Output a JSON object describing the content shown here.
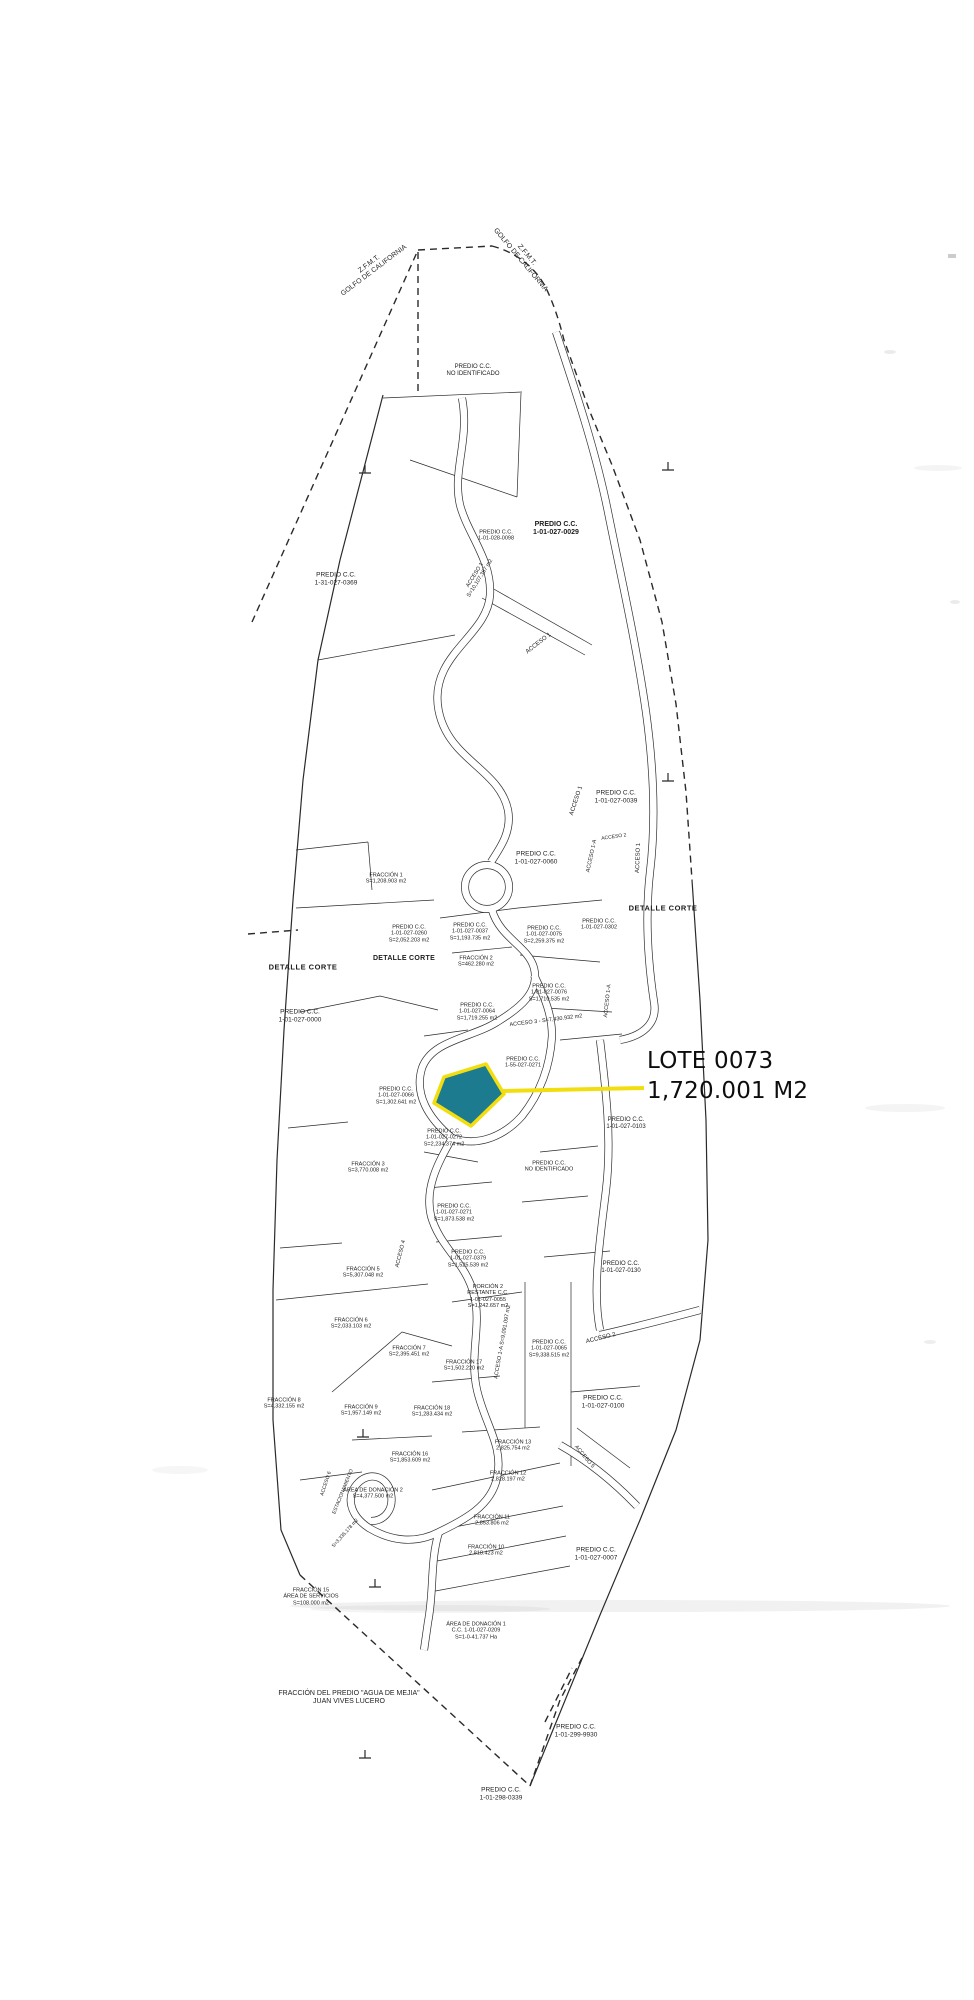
{
  "page": {
    "background": "#ffffff"
  },
  "ink": "#2a2a2a",
  "callout": {
    "title": "LOTE 0073",
    "area": "1,720.001 M2"
  },
  "highlight": {
    "fill": "#1c7b8e",
    "stroke": "#f2de0e",
    "leader_color": "#f2de0e"
  },
  "map": {
    "labels": [
      {
        "text": "Z.F.M.T.\nGOLFO DE CALIFORNIA",
        "x": 372,
        "y": 268,
        "rot": -37,
        "size": 7
      },
      {
        "text": "Z.F.M.T.\nGOLFO DE CALIFORNIA",
        "x": 523,
        "y": 258,
        "rot": 50,
        "size": 7
      },
      {
        "text": "PREDIO C.C.\nNO IDENTIFICADO",
        "x": 473,
        "y": 371,
        "rot": 0,
        "size": 6
      },
      {
        "text": "PREDIO C.C.\n1-31-027-0369",
        "x": 336,
        "y": 579,
        "rot": 0,
        "size": 6.5
      },
      {
        "text": "PREDIO C.C.\n1-01-028-0098",
        "x": 496,
        "y": 536,
        "rot": 0,
        "size": 5.5
      },
      {
        "text": "PREDIO C.C.\n1-01-027-0029",
        "x": 556,
        "y": 529,
        "rot": 0,
        "size": 7,
        "weight": 700
      },
      {
        "text": "ACCESO 1\nS=10,107.387 m2",
        "x": 478,
        "y": 577,
        "rot": -58,
        "size": 5.5
      },
      {
        "text": "ACCESO 1",
        "x": 539,
        "y": 644,
        "rot": -38,
        "size": 6
      },
      {
        "text": "PREDIO C.C.\n1-01-027-0039",
        "x": 616,
        "y": 797,
        "rot": 0,
        "size": 6.5
      },
      {
        "text": "ACCESO 1",
        "x": 577,
        "y": 801,
        "rot": -72,
        "size": 6
      },
      {
        "text": "ACCESO 2",
        "x": 614,
        "y": 838,
        "rot": -8,
        "size": 5
      },
      {
        "text": "ACCESO 1-A",
        "x": 592,
        "y": 856,
        "rot": -78,
        "size": 5.5
      },
      {
        "text": "ACCESO 1",
        "x": 639,
        "y": 858,
        "rot": -88,
        "size": 6
      },
      {
        "text": "PREDIO C.C.\n1-01-027-0060",
        "x": 536,
        "y": 858,
        "rot": 0,
        "size": 6.5
      },
      {
        "text": "FRACCIÓN 1\nS=1,208.903 m2",
        "x": 386,
        "y": 879,
        "rot": 0,
        "size": 5.5
      },
      {
        "text": "DETALLE CORTE",
        "x": 303,
        "y": 968,
        "rot": 0,
        "size": 7.5,
        "weight": 600,
        "spacing": 0.5
      },
      {
        "text": "DETALLE CORTE",
        "x": 663,
        "y": 909,
        "rot": 0,
        "size": 7.5,
        "weight": 600,
        "spacing": 0.5
      },
      {
        "text": "PREDIO C.C.\n1-01-027-0260\nS=2,052.203 m2",
        "x": 409,
        "y": 934,
        "rot": 0,
        "size": 5.5
      },
      {
        "text": "DETALLE CORTE",
        "x": 404,
        "y": 959,
        "rot": 0,
        "size": 7,
        "weight": 700,
        "spacing": 0.3
      },
      {
        "text": "PREDIO C.C.\n1-01-027-0037\nS=1,193.735 m2",
        "x": 470,
        "y": 932,
        "rot": 0,
        "size": 5.5
      },
      {
        "text": "PREDIO C.C.\n1-01-027-0075\nS=2,259.375 m2",
        "x": 544,
        "y": 935,
        "rot": 0,
        "size": 5.5
      },
      {
        "text": "PREDIO C.C.\n1-01-027-0302",
        "x": 599,
        "y": 925,
        "rot": 0,
        "size": 5.5
      },
      {
        "text": "FRACCIÓN 2\nS=462.280 m2",
        "x": 476,
        "y": 962,
        "rot": 0,
        "size": 5.5
      },
      {
        "text": "PREDIO C.C.\n1-01-027-0076\nS=1,710.535 m2",
        "x": 549,
        "y": 993,
        "rot": 0,
        "size": 5.5
      },
      {
        "text": "PREDIO C.C.\n1-01-027-0064\nS=1,719.255 m2",
        "x": 477,
        "y": 1012,
        "rot": 0,
        "size": 5.5
      },
      {
        "text": "ACCESO 3 - S=7,430.932 m2",
        "x": 546,
        "y": 1021,
        "rot": -7,
        "size": 5.5
      },
      {
        "text": "ACCESO 1-A",
        "x": 608,
        "y": 1001,
        "rot": -84,
        "size": 5.5
      },
      {
        "text": "PREDIO C.C.\n1-01-027-0000",
        "x": 300,
        "y": 1016,
        "rot": 0,
        "size": 6.5
      },
      {
        "text": "PREDIO C.C.\n1-01-027-0066\nS=1,302.641 m2",
        "x": 396,
        "y": 1096,
        "rot": 0,
        "size": 5.5
      },
      {
        "text": "PREDIO C.C.\n1-55-027-0271",
        "x": 523,
        "y": 1063,
        "rot": 0,
        "size": 5.5
      },
      {
        "text": "PREDIO C.C.\n1-01-027-0272\nS=2,234.374 m2",
        "x": 444,
        "y": 1138,
        "rot": 0,
        "size": 5.5
      },
      {
        "text": "PREDIO C.C.\n1-01-027-0103",
        "x": 626,
        "y": 1124,
        "rot": 0,
        "size": 6
      },
      {
        "text": "PREDIO C.C.\nNO IDENTIFICADO",
        "x": 549,
        "y": 1167,
        "rot": 0,
        "size": 5.5
      },
      {
        "text": "FRACCIÓN 3\nS=3,770.008 m2",
        "x": 368,
        "y": 1168,
        "rot": 0,
        "size": 5.5
      },
      {
        "text": "PREDIO C.C.\n1-01-027-0271\nS=1,873.538 m2",
        "x": 454,
        "y": 1213,
        "rot": 0,
        "size": 5.5
      },
      {
        "text": "PREDIO C.C.\n1-01-027-0379\nS=1,525.539 m2",
        "x": 468,
        "y": 1259,
        "rot": 0,
        "size": 5.5
      },
      {
        "text": "FRACCIÓN 5\nS=5,307.048 m2",
        "x": 363,
        "y": 1273,
        "rot": 0,
        "size": 5.5
      },
      {
        "text": "ACCESO 4",
        "x": 401,
        "y": 1254,
        "rot": -76,
        "size": 5.5
      },
      {
        "text": "PREDIO C.C.\n1-01-027-0130",
        "x": 621,
        "y": 1268,
        "rot": 0,
        "size": 6
      },
      {
        "text": "FRACCIÓN 6\nS=2,033.103 m2",
        "x": 351,
        "y": 1324,
        "rot": 0,
        "size": 5.5
      },
      {
        "text": "PORCIÓN 2\nRESTANTE C.C.\n1-01-027-0055\nS=1,242.657 m2",
        "x": 488,
        "y": 1297,
        "rot": 0,
        "size": 5.5
      },
      {
        "text": "FRACCIÓN 7\nS=2,395.451 m2",
        "x": 409,
        "y": 1352,
        "rot": 0,
        "size": 5.5
      },
      {
        "text": "FRACCIÓN 17\nS=1,502.220 m2",
        "x": 464,
        "y": 1366,
        "rot": 0,
        "size": 5.5
      },
      {
        "text": "ACCESO 1-A  S=9,091.097 m2",
        "x": 503,
        "y": 1342,
        "rot": -80,
        "size": 5.5
      },
      {
        "text": "PREDIO C.C.\n1-01-027-0065\nS=9,338.515 m2",
        "x": 549,
        "y": 1349,
        "rot": 0,
        "size": 5.5
      },
      {
        "text": "ACCESO 2",
        "x": 601,
        "y": 1339,
        "rot": -14,
        "size": 6
      },
      {
        "text": "PREDIO C.C.\n1-01-027-0100",
        "x": 603,
        "y": 1402,
        "rot": 0,
        "size": 6.5
      },
      {
        "text": "FRACCIÓN 9\nS=1,957.149 m2",
        "x": 361,
        "y": 1411,
        "rot": 0,
        "size": 5.5
      },
      {
        "text": "FRACCIÓN 18\nS=1,283.434 m2",
        "x": 432,
        "y": 1412,
        "rot": 0,
        "size": 5.5
      },
      {
        "text": "FRACCIÓN 13\n2,825.754 m2",
        "x": 513,
        "y": 1446,
        "rot": 0,
        "size": 5.5
      },
      {
        "text": "FRACCIÓN 16\nS=1,853.609 m2",
        "x": 410,
        "y": 1458,
        "rot": 0,
        "size": 5.5
      },
      {
        "text": "ACCESO 5",
        "x": 584,
        "y": 1457,
        "rot": 50,
        "size": 5.5
      },
      {
        "text": "FRACCIÓN 8\nS=4,332.155 m2",
        "x": 284,
        "y": 1404,
        "rot": 0,
        "size": 5.5
      },
      {
        "text": "ÁREA DE DONACIÓN 2\nS=4,377.500 m2",
        "x": 373,
        "y": 1494,
        "rot": 0,
        "size": 5.5
      },
      {
        "text": "FRACCIÓN 12\n2,828.197 m2",
        "x": 508,
        "y": 1477,
        "rot": 0,
        "size": 5.5
      },
      {
        "text": "FRACCIÓN 11\n2,853.806 m2",
        "x": 492,
        "y": 1521,
        "rot": 0,
        "size": 5.5
      },
      {
        "text": "FRACCIÓN 10\n2,818.423 m2",
        "x": 486,
        "y": 1551,
        "rot": 0,
        "size": 5.5
      },
      {
        "text": "PREDIO C.C.\n1-01-027-0007",
        "x": 596,
        "y": 1554,
        "rot": 0,
        "size": 6.5
      },
      {
        "text": "FRACCIÓN 15\nÁREA DE SERVICIOS\nS=108.000 m2",
        "x": 311,
        "y": 1597,
        "rot": 0,
        "size": 5.5
      },
      {
        "text": "ÁREA DE DONACIÓN 1\nC.C. 1-01-027-0209\nS=1-0-41.737 Ha",
        "x": 476,
        "y": 1631,
        "rot": 0,
        "size": 5.5
      },
      {
        "text": "ACCESO 6",
        "x": 327,
        "y": 1484,
        "rot": -72,
        "size": 5
      },
      {
        "text": "ESTACIONAMIENTO",
        "x": 344,
        "y": 1492,
        "rot": -68,
        "size": 5
      },
      {
        "text": "S=3,335.178 m2",
        "x": 346,
        "y": 1534,
        "rot": -48,
        "size": 5
      },
      {
        "text": "FRACCIÓN DEL PREDIO \"AGUA DE MEJIA\"\nJUAN VIVES LUCERO",
        "x": 349,
        "y": 1698,
        "rot": 0,
        "size": 7
      },
      {
        "text": "PREDIO C.C.\n1-01-299-9930",
        "x": 576,
        "y": 1731,
        "rot": 0,
        "size": 6.5
      },
      {
        "text": "PREDIO C.C.\n1-01-298-0339",
        "x": 501,
        "y": 1794,
        "rot": 0,
        "size": 6.5
      }
    ],
    "ticks": [
      [
        365,
        473
      ],
      [
        668,
        470
      ],
      [
        668,
        781
      ],
      [
        363,
        1437
      ],
      [
        375,
        1587
      ],
      [
        365,
        1758
      ]
    ]
  }
}
